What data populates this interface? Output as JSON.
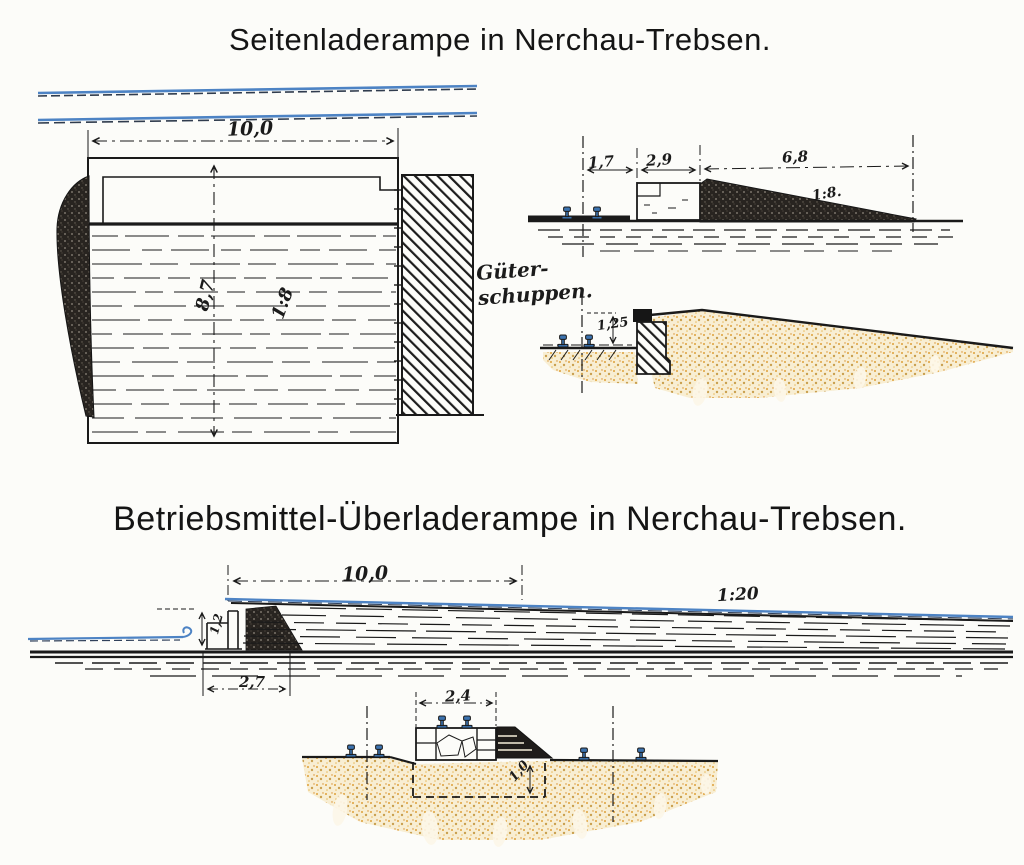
{
  "drawing1": {
    "title": "Seitenladerampe in Nerchau-Trebsen.",
    "plan": {
      "width_label": "10,0",
      "depth_label": "8,7",
      "slope_label": "1:8",
      "shed_label_line1": "Güter-",
      "shed_label_line2": "schuppen."
    },
    "section_upper": {
      "dim_left": "1,7",
      "dim_middle": "2,9",
      "dim_right": "6,8",
      "slope_label": "1:8."
    },
    "section_lower": {
      "height_label": "1,25"
    }
  },
  "drawing2": {
    "title": "Betriebsmittel-Überladerampe in Nerchau-Trebsen.",
    "long_section": {
      "width_label": "10,0",
      "slope_label": "1:20",
      "wall_height_label": "1,2",
      "wall_width_label": "2,7"
    },
    "cross_section": {
      "width_label": "2,4",
      "foundation_depth_label": "1,0"
    }
  },
  "colors": {
    "ink": "#1b1b1b",
    "water_blue": "#4d83c4",
    "rail_blue": "#3b72ae",
    "sand": "#dfa03a"
  }
}
